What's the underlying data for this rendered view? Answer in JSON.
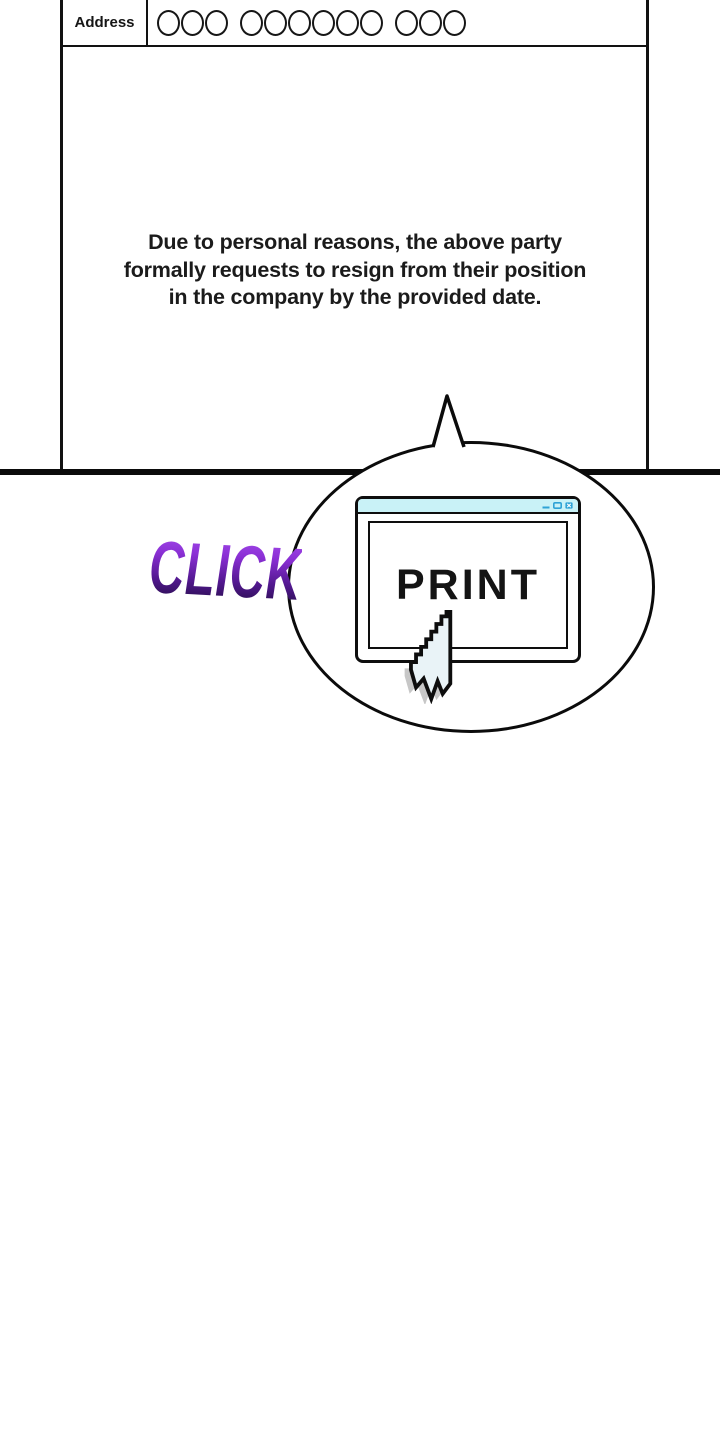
{
  "form": {
    "address_label": "Address",
    "address_value_circle_groups": [
      3,
      6,
      3
    ],
    "body_text_lines": [
      "Due to personal reasons, the above party",
      "formally requests to resign from their position",
      "in the company by the provided date."
    ]
  },
  "sfx": {
    "click_label": "CLICK"
  },
  "print_window": {
    "button_label": "PRINT",
    "titlebar_controls": [
      "minimize",
      "maximize",
      "close"
    ]
  },
  "colors": {
    "ink": "#111111",
    "titlebar_cyan": "#c9f2f7",
    "control_blue": "#2fa3d6",
    "click_gradient_top": "#a54cec",
    "click_gradient_bottom": "#200c40",
    "cursor_fill": "#e9f3f7",
    "cursor_shadow": "#bdbdbd"
  }
}
